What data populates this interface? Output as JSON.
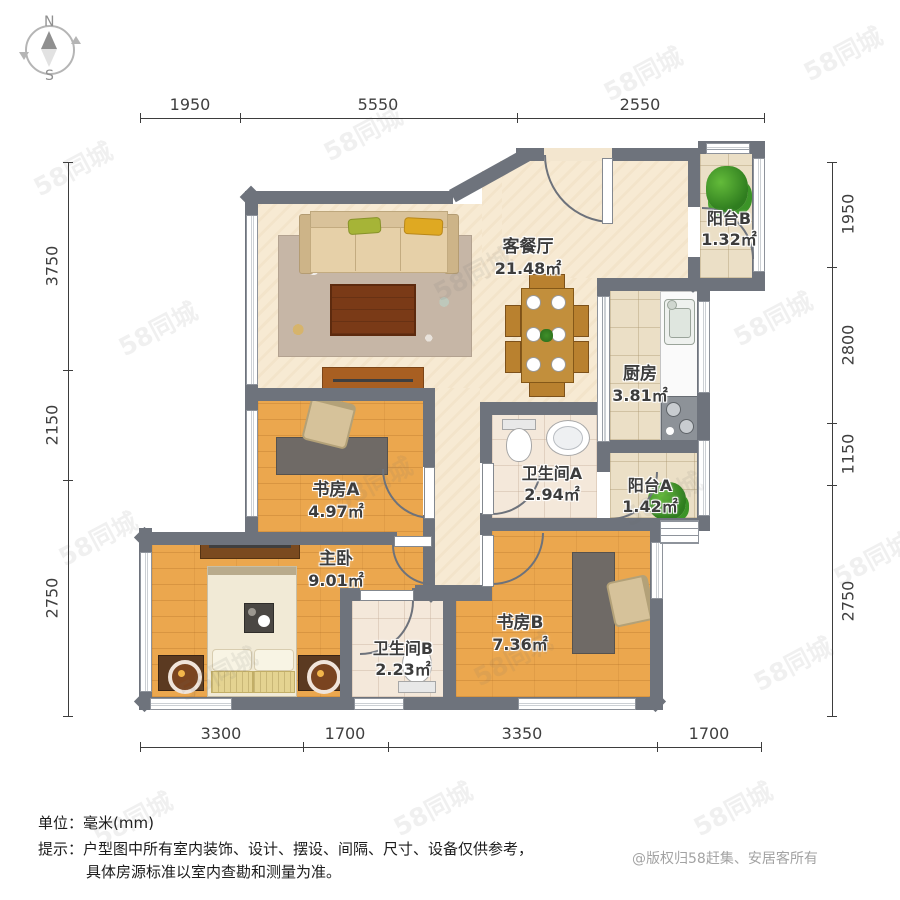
{
  "compass": {
    "north": "N",
    "south": "S"
  },
  "rooms": [
    {
      "key": "living",
      "name": "客餐厅",
      "area": "21.48㎡"
    },
    {
      "key": "balcony_b",
      "name": "阳台B",
      "area": "1.32㎡"
    },
    {
      "key": "kitchen",
      "name": "厨房",
      "area": "3.81㎡"
    },
    {
      "key": "bath_a",
      "name": "卫生间A",
      "area": "2.94㎡"
    },
    {
      "key": "balcony_a",
      "name": "阳台A",
      "area": "1.42㎡"
    },
    {
      "key": "study_a",
      "name": "书房A",
      "area": "4.97㎡"
    },
    {
      "key": "master",
      "name": "主卧",
      "area": "9.01㎡"
    },
    {
      "key": "bath_b",
      "name": "卫生间B",
      "area": "2.23㎡"
    },
    {
      "key": "study_b",
      "name": "书房B",
      "area": "7.36㎡"
    }
  ],
  "dimensions": {
    "top": [
      "1950",
      "5550",
      "2550"
    ],
    "bottom": [
      "3300",
      "1700",
      "3350",
      "1700"
    ],
    "left": [
      "3750",
      "2150",
      "2750"
    ],
    "right": [
      "1950",
      "2800",
      "1150",
      "2750"
    ]
  },
  "footer": {
    "unit": "单位：毫米(mm)",
    "tip_line1": "提示：户型图中所有室内装饰、设计、摆设、间隔、尺寸、设备仅供参考，",
    "tip_line2": "具体房源标准以室内查勘和测量为准。",
    "copyright": "@版权归58赶集、安居客所有"
  },
  "watermark": {
    "text": "58同城"
  },
  "colors": {
    "wall": "#6e737c",
    "wood_floor": "#eba74e",
    "cream_floor": "#f7ead3",
    "tile_floor": "#ebdfc6",
    "plant_green": "#4ea632",
    "accent_brown": "#a85f22"
  }
}
